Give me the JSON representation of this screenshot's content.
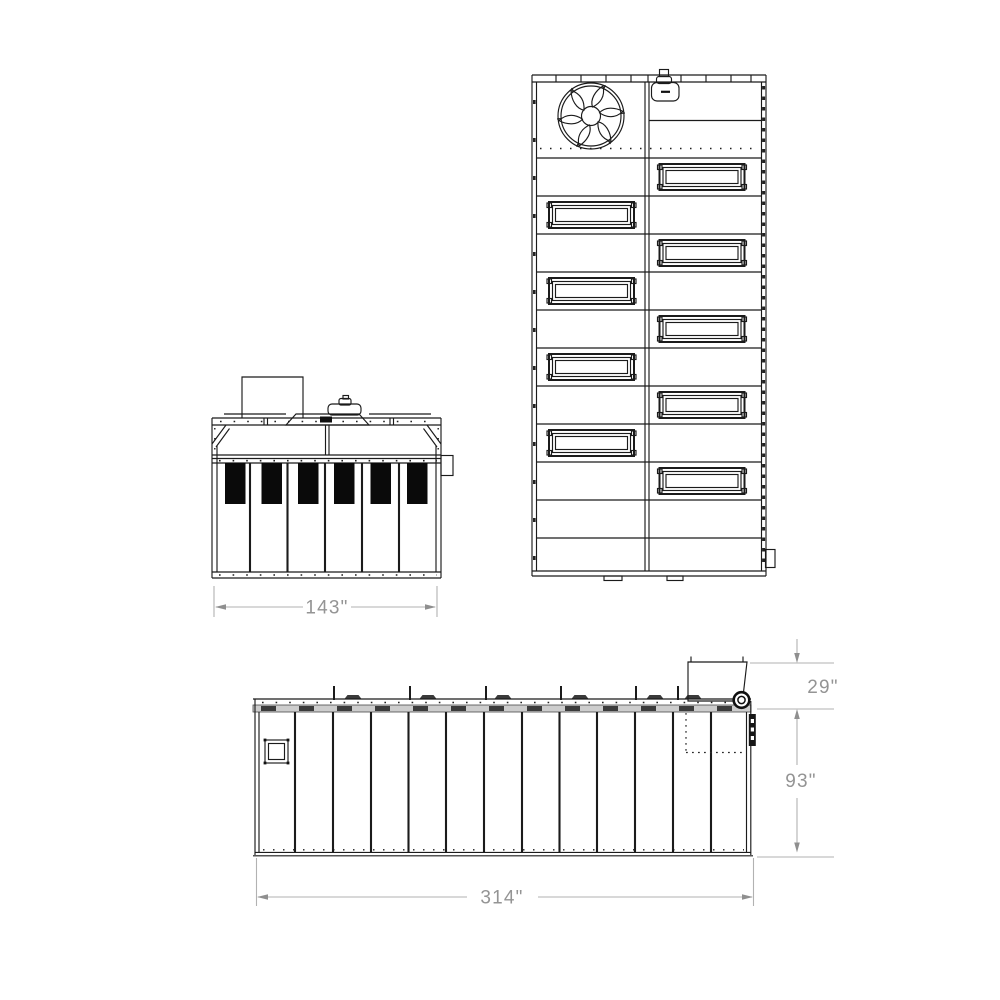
{
  "drawing": {
    "type": "technical-multiview-drawing",
    "views": {
      "front": "front-elevation",
      "plan": "top-plan",
      "side": "side-elevation"
    },
    "dimension_labels": {
      "front_width": "143\"",
      "side_length": "314\"",
      "side_body_height": "93\"",
      "side_duct_height": "29\""
    },
    "component_counts": {
      "filter_bags_front_view": 6,
      "access_panels_plan_view": 9,
      "wall_panels_side_view": 13
    },
    "colors": {
      "line": "#1b1b1b",
      "dimension": "#9a9a9a",
      "filter_fill": "#0a0a0a",
      "rail_band": "#cdcdcd",
      "background": "#ffffff"
    }
  }
}
